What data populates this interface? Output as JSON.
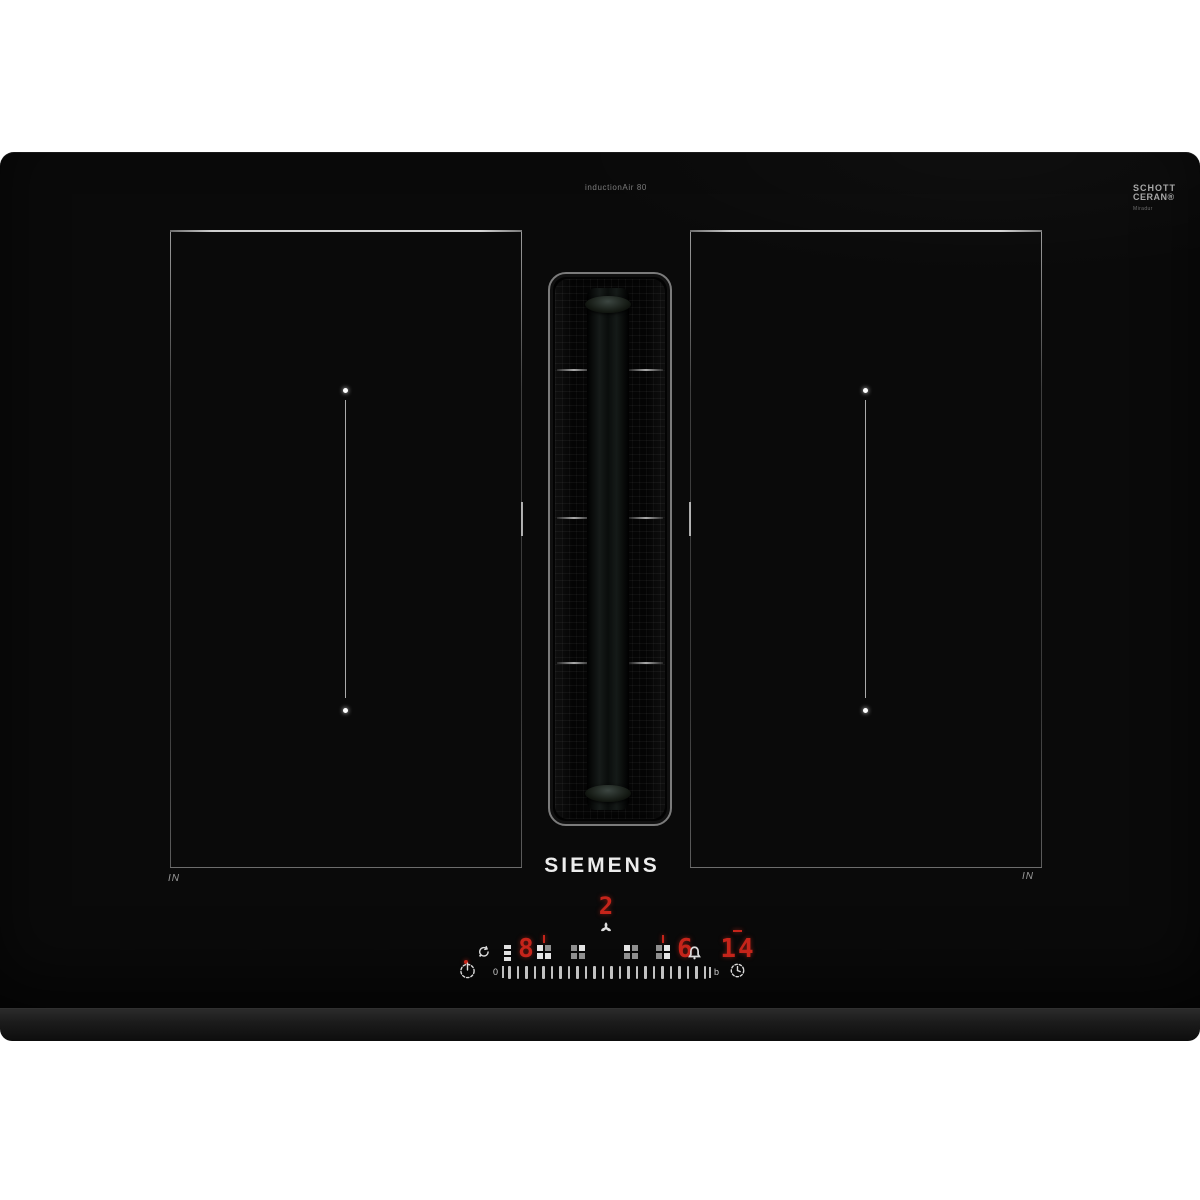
{
  "header": {
    "series_label": "inductionAir 80",
    "glass_brand": {
      "line1": "SCHOTT",
      "line2": "CERAN®",
      "subline": "Miradur"
    }
  },
  "brand": {
    "logo": "SIEMENS"
  },
  "zones": {
    "left_mark": "IN",
    "right_mark": "IN"
  },
  "controls": {
    "vent_level": "2",
    "left_zone_level": "8",
    "right_zone_level": "6",
    "timer_display": "14",
    "slider": {
      "min_label": "0",
      "max_label": "b",
      "segments": 24
    }
  },
  "colors": {
    "led_red": "#c5241a",
    "icon_white": "#d9d9d9",
    "glass_black": "#0a0a0a"
  },
  "icons": {
    "fan-icon": "three-blade ventilation fan",
    "clean-lock-icon": "wipe-protection swirl",
    "flex-bar-icon": "segmented flex-zone bar",
    "zone-icon": "2x2 cookware squares",
    "bell-icon": "timer alarm bell",
    "power-icon": "power on/off symbol",
    "clock-icon": "timer clock dial"
  }
}
